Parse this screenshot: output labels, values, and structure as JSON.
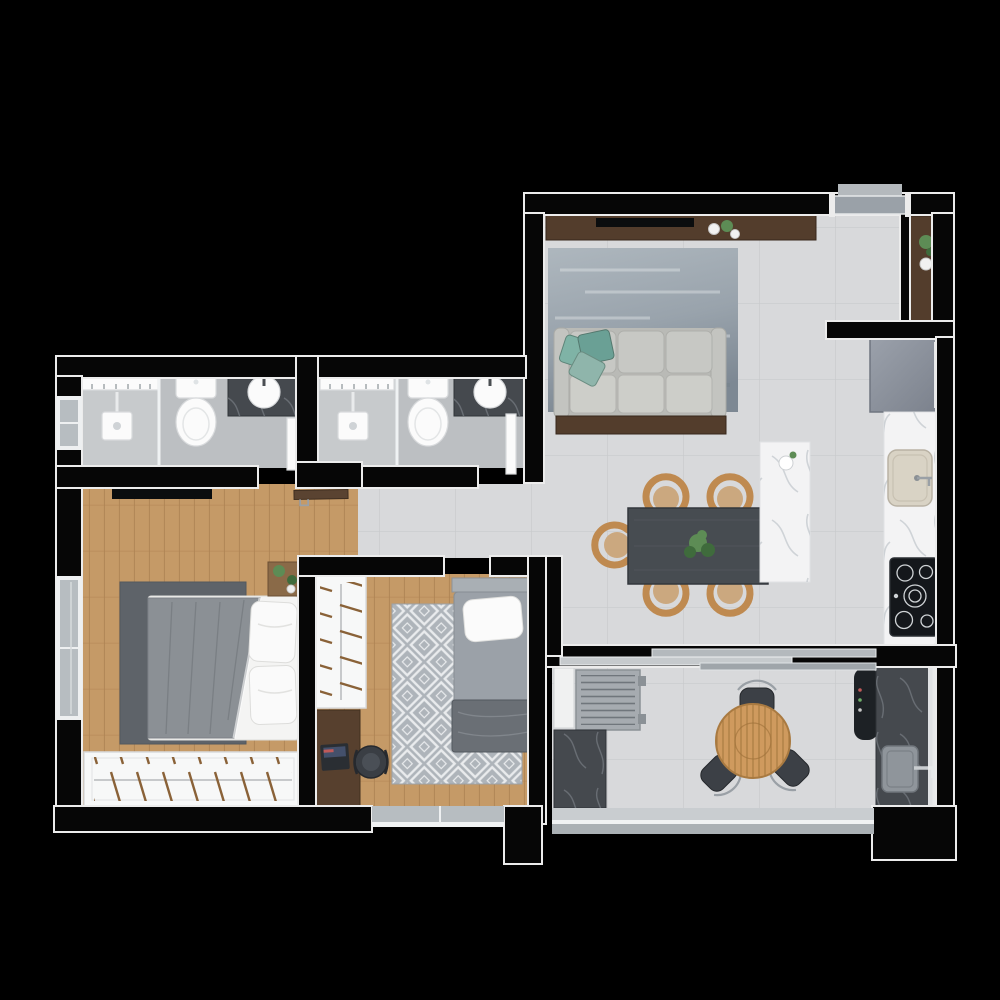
{
  "scene": {
    "kind": "apartment-floor-plan",
    "view": "top-down-3d-render",
    "background": "#000000",
    "visible_text": ""
  },
  "palette": {
    "bg": "#000000",
    "wallFill": "#060606",
    "trim": "#ececec",
    "tile": "#d8d9db",
    "tileLine": "#c8cacc",
    "bathTile": "#bcbfc2",
    "showerTile": "#c7cacc",
    "wood": "#c59a67",
    "woodLine": "#aa7f50",
    "darkwood": "#533d2c",
    "sofa": "#c7c8c4",
    "pillowTeal": "#6aa095",
    "rugMaster": "#5e6369",
    "rugPattern": "#aeb4ba",
    "table": "#474c51",
    "chairWood": "#bf8a50",
    "marble": "#f3f3f4",
    "darkMarble": "#45494e",
    "fridge": "#8d939d",
    "cooktop": "#14171b",
    "fixtureWhite": "#fbfbfb",
    "sinkBeige": "#d9d3c5",
    "windowGlass": "#b7bdc1",
    "metal": "#9aa0a6",
    "balconyChair": "#3c4046",
    "woodTable": "#cf9a5e",
    "bedDuvet": "#8b9095",
    "mattress": "#9ba1a8",
    "bench": "#6a6f75",
    "plant": "#5d8c55",
    "plantDark": "#3f6b3c",
    "laptop": "#2a2e33"
  },
  "rooms": {
    "living": {
      "label": "Living, dining and kitchen",
      "furniture": [
        "tv-console",
        "tv",
        "decor-plants",
        "area-rug",
        "sofa",
        "teal-throw-pillows",
        "console-behind-sofa",
        "dining-table",
        "five-wood-dining-chairs",
        "centerpiece-plant",
        "marble-island",
        "flower-vase",
        "entry-door",
        "entry-console",
        "refrigerator",
        "kitchen-counter",
        "kitchen-sink",
        "cooktop"
      ]
    },
    "bathroom1": {
      "label": "Bathroom 1 (en-suite)",
      "furniture": [
        "shower",
        "glass-partition",
        "niche-shelf",
        "shower-mixer",
        "toilet",
        "stone-vanity",
        "vessel-sink",
        "door",
        "window"
      ]
    },
    "bathroom2": {
      "label": "Bathroom 2",
      "furniture": [
        "shower",
        "glass-partition",
        "niche-shelf",
        "shower-mixer",
        "toilet",
        "stone-vanity",
        "vessel-sink",
        "door"
      ]
    },
    "master": {
      "label": "Master bedroom",
      "furniture": [
        "wall-tv",
        "area-rug",
        "double-bed",
        "gray-duvet",
        "two-pillow-stacks",
        "nightstand",
        "plants",
        "open-wardrobe-with-hangers",
        "window",
        "wood-entry-door"
      ]
    },
    "bedroom2": {
      "label": "Bedroom 2",
      "furniture": [
        "open-wardrobe-with-hangers",
        "desk",
        "laptop",
        "desk-chair",
        "diamond-pattern-rug",
        "single-bed",
        "pillow",
        "blanket-chest",
        "window"
      ]
    },
    "hallway": {
      "label": "Hallway",
      "furniture": []
    },
    "balcony": {
      "label": "Balcony and service area",
      "furniture": [
        "sliding-glass-door",
        "white-cabinet",
        "ac-condenser-unit",
        "service-counter-left",
        "round-wood-table",
        "three-outdoor-chairs",
        "grill",
        "service-counter-right",
        "outdoor-sink",
        "glass-railing"
      ]
    }
  }
}
